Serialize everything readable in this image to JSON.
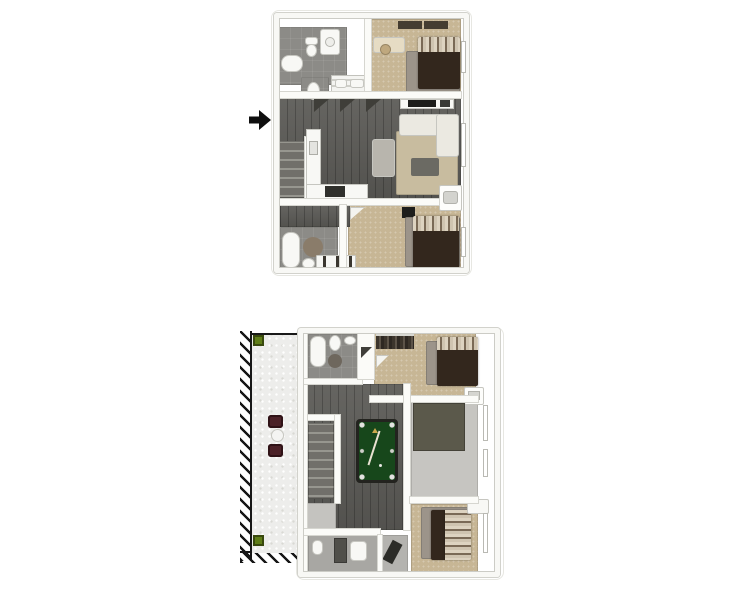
{
  "page": {
    "background": "#ffffff"
  },
  "palette": {
    "wall": "#fbfbf8",
    "wall_edge": "#d6d6d0",
    "wood_floor": "#5c5b57",
    "carpet_tan": "#c7b695",
    "tile_gray": "#8c8b87",
    "tile_light": "#a8a7a3",
    "floor_light": "#c6c5c1",
    "pool_felt": "#17471b",
    "pool_frame": "#23231f",
    "bed_dark": "#33271d",
    "rug_gray": "#9c948a",
    "sofa_white": "#ebe9e1",
    "patio_concrete": "#ededeb",
    "hatch_black": "#171717",
    "chair_maroon": "#4b2127",
    "plant_green": "#5f7d18",
    "accent_olive": "#5b594b",
    "arrow_black": "#0f0f0f"
  },
  "plans": {
    "upper": {
      "label": "Upper floor 3D plan",
      "rooms": [
        "bathroom",
        "water-closet",
        "closet",
        "bedroom",
        "kitchen",
        "living-room",
        "stairs",
        "bathroom-2",
        "bedroom-2"
      ],
      "furniture": [
        "bathtub",
        "toilet",
        "vanity-sink",
        "bed",
        "desk",
        "wall-art",
        "sofa",
        "coffee-table",
        "kitchen-island",
        "bar-stools",
        "tv-console",
        "rugs",
        "dresser"
      ],
      "entry_arrow": "left-side-entry"
    },
    "lower": {
      "label": "Lower floor 3D plan with patio",
      "rooms": [
        "patio",
        "bathroom",
        "bedroom",
        "game-room",
        "stairs",
        "flex-room",
        "bedroom-2",
        "bathroom-2",
        "closet",
        "landing"
      ],
      "furniture": [
        "pool-table",
        "patio-chairs",
        "patio-table",
        "plants",
        "bathtub",
        "toilet",
        "sink",
        "shower",
        "beds",
        "rugs",
        "hanging-clothes",
        "shelf"
      ]
    }
  }
}
